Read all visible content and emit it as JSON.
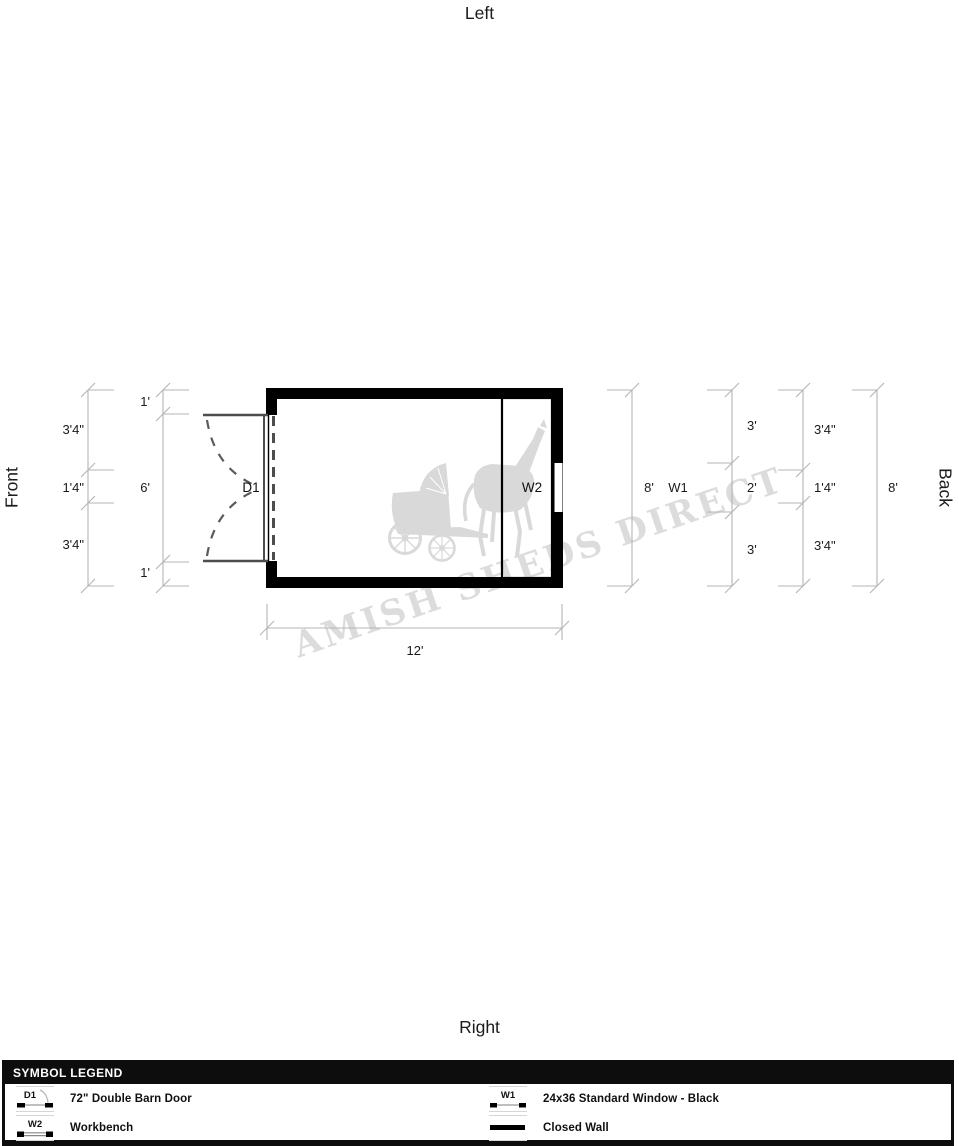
{
  "orientation": {
    "top": "Left",
    "left": "Front",
    "right": "Back",
    "bottom": "Right"
  },
  "plan": {
    "door_label": "D1",
    "workbench_label": "W2",
    "dimensions": {
      "left_outer": [
        "3'4\"",
        "1'4\"",
        "3'4\""
      ],
      "left_inner": [
        "1'",
        "6'",
        "1'"
      ],
      "front_overall": "8'",
      "window_ref": "W1",
      "right_inner": [
        "3'",
        "2'",
        "3'"
      ],
      "right_outer": [
        "3'4\"",
        "1'4\"",
        "3'4\""
      ],
      "back_overall": "8'",
      "width_overall": "12'"
    }
  },
  "watermark": {
    "text": "AMISH SHEDS DIRECT"
  },
  "legend": {
    "title": "SYMBOL LEGEND",
    "items": [
      {
        "id": "D1",
        "label": "72\" Double Barn Door",
        "type": "door"
      },
      {
        "id": "W1",
        "label": "24x36 Standard Window - Black",
        "type": "window"
      },
      {
        "id": "W2",
        "label": "Workbench",
        "type": "workbench"
      },
      {
        "id": "",
        "label": "Closed Wall",
        "type": "closed-wall"
      }
    ]
  },
  "colors": {
    "wall": "#000000",
    "dimension_line": "#b5b5b5",
    "watermark": "#dcdcdc",
    "legend_header_bg": "#0d0d0d"
  }
}
